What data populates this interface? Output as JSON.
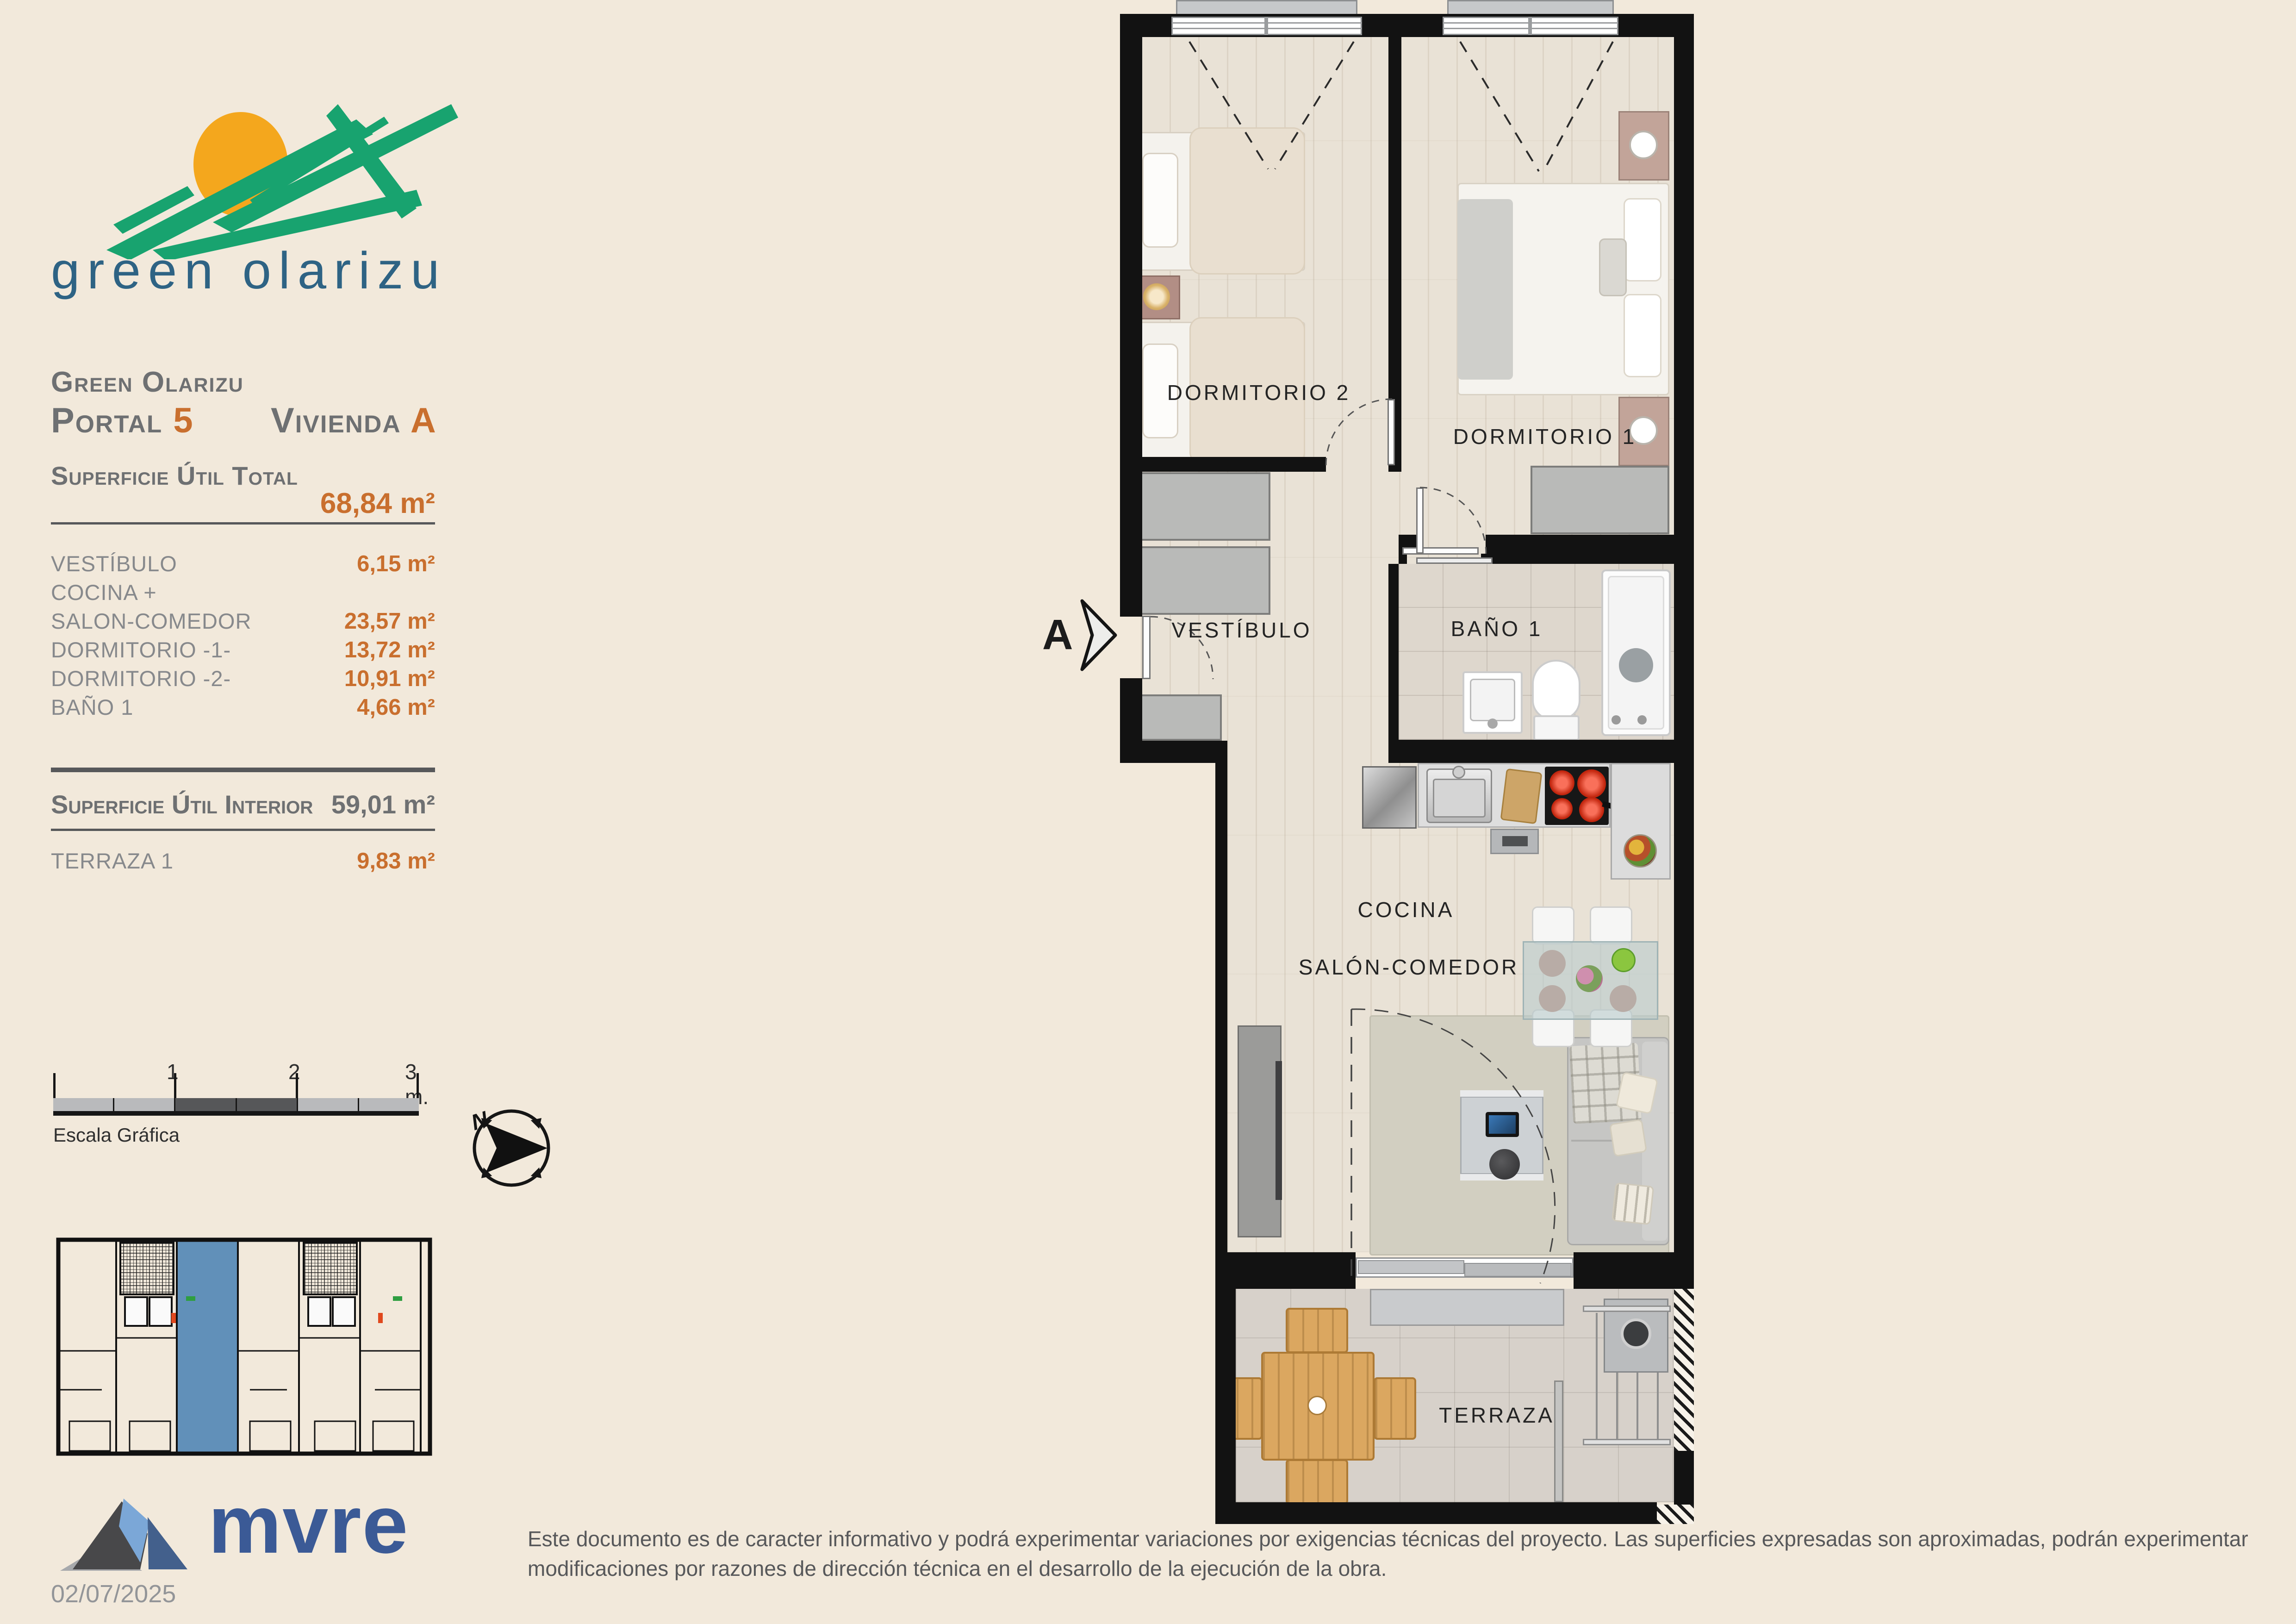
{
  "page": {
    "background": "#f2e9db"
  },
  "brand": {
    "logo_text": "green olarizu",
    "green": "#18a36f",
    "sun": "#f4a71d",
    "text_color": "#2e6384"
  },
  "header": {
    "project": "Green Olarizu",
    "portal_label": "Portal",
    "portal_number": "5",
    "vivienda_label": "Vivienda",
    "vivienda_letter": "A"
  },
  "surface_table": {
    "total_label": "Superficie Útil Total",
    "total_value": "68,84 m²",
    "rows": [
      {
        "label": "VESTÍBULO",
        "value": "6,15 m²"
      },
      {
        "label": "COCINA +",
        "value": ""
      },
      {
        "label": "SALON-COMEDOR",
        "value": "23,57 m²"
      },
      {
        "label": "DORMITORIO -1-",
        "value": "13,72 m²"
      },
      {
        "label": "DORMITORIO -2-",
        "value": "10,91 m²"
      },
      {
        "label": "BAÑO 1",
        "value": "4,66 m²"
      }
    ],
    "interior_label": "Superficie Útil Interior",
    "interior_value": "59,01 m²",
    "terraza_label": "TERRAZA 1",
    "terraza_value": "9,83 m²"
  },
  "scale_bar": {
    "ticks": [
      "1",
      "2",
      "3 m."
    ],
    "caption": "Escala Gráfica"
  },
  "compass": {
    "north_label": "N"
  },
  "plan": {
    "section_marker": "A",
    "rooms": {
      "dormitorio2": "DORMITORIO 2",
      "dormitorio1": "DORMITORIO 1",
      "vestibulo": "VESTÍBULO",
      "bano1": "BAÑO 1",
      "cocina": "COCINA",
      "salon": "SALÓN-COMEDOR",
      "terraza": "TERRAZA"
    }
  },
  "footer": {
    "logo_text": "mvre",
    "date": "02/07/2025",
    "disclaimer": "Este documento es de caracter informativo y podrá experimentar variaciones por exigencias técnicas del proyecto. Las superficies expresadas son aproximadas, podrán experimentar modificaciones por razones de dirección técnica en el desarrollo de la ejecución de la obra."
  },
  "colors": {
    "accent_orange": "#c96f2e",
    "heading_gray": "#6e7072",
    "row_gray": "#87898c",
    "wall_black": "#121212",
    "highlight_unit_blue": "#6190b9",
    "mvre_blue": "#3b5a96"
  }
}
